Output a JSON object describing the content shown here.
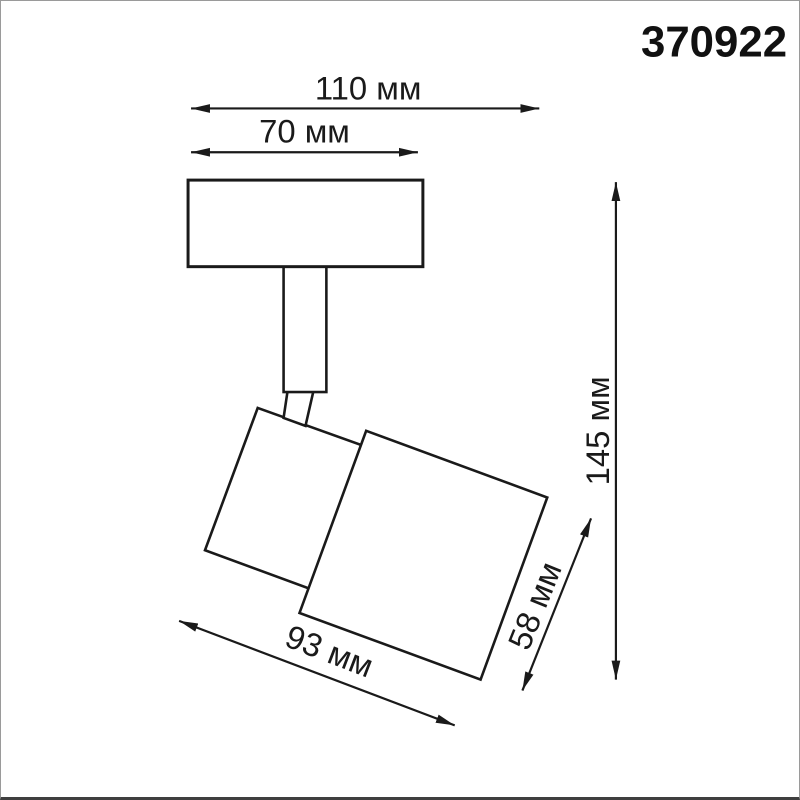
{
  "product": {
    "code": "370922"
  },
  "drawing": {
    "type": "technical-dimension-drawing",
    "subject": "ceiling-spot-light-fixture",
    "unit": "мм",
    "dimensions": {
      "overall_width": {
        "label": "110 мм",
        "value": 110,
        "orientation": "horizontal"
      },
      "base_width": {
        "label": "70 мм",
        "value": 70,
        "orientation": "horizontal"
      },
      "overall_height": {
        "label": "145 мм",
        "value": 145,
        "orientation": "vertical"
      },
      "head_depth": {
        "label": "58 мм",
        "value": 58,
        "orientation": "diagonal"
      },
      "head_length": {
        "label": "93 мм",
        "value": 93,
        "orientation": "diagonal"
      }
    }
  },
  "colors": {
    "line": "#1a1a1a",
    "background": "#ffffff",
    "frame_border": "#9a9a9a",
    "frame_border_bottom": "#3f3f3f"
  }
}
